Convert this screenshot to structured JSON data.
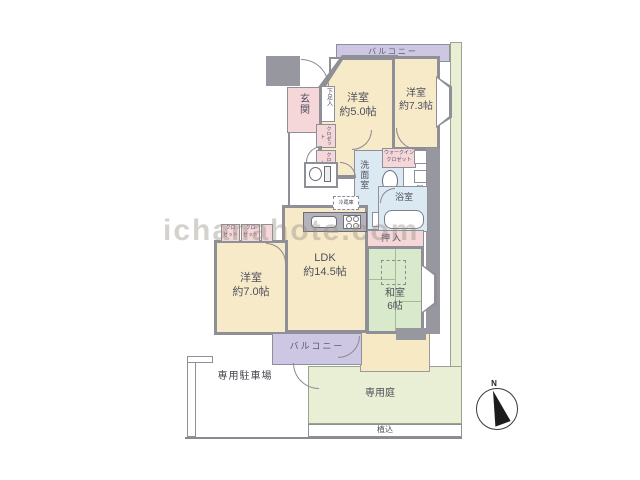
{
  "plan_type": "apartment-floor-plan",
  "colors": {
    "wall": "#8f8f97",
    "room_cream": "#f7eac8",
    "closet_pink": "#f5d7d9",
    "wet_area_blue": "#dbe9f3",
    "tatami_green": "#d9e9cb",
    "balcony_purple": "#cdc7e3",
    "garden_green": "#e8efd4"
  },
  "labels": {
    "balcony_top": "バルコニー",
    "balcony_bottom": "バルコニー",
    "mb": "MB",
    "genkan": "玄関",
    "shoe_box": "下足入",
    "closet_vertical_1": "クロゼット",
    "closet_vertical_2": "クロゼット",
    "closet_a": "クロ\nゼット",
    "closet_b": "クロ\nゼット",
    "walk_in_closet": "ウォークイン\nクロゼット",
    "ps": "PS",
    "washroom": "洗面室",
    "bathroom": "浴室",
    "oshiire": "押入",
    "refrigerator": "冷蔵庫",
    "ldk": "LDK\n約14.5帖",
    "washitsu": "和室\n6帖",
    "western_room_5": "洋室\n約5.0帖",
    "western_room_7_3": "洋室\n約7.3帖",
    "western_room_7_0": "洋室\n約7.0帖",
    "parking": "専用駐車場",
    "garden": "専用庭",
    "planting": "植込",
    "compass_north": "N",
    "watermark": "ichanahote.com"
  }
}
